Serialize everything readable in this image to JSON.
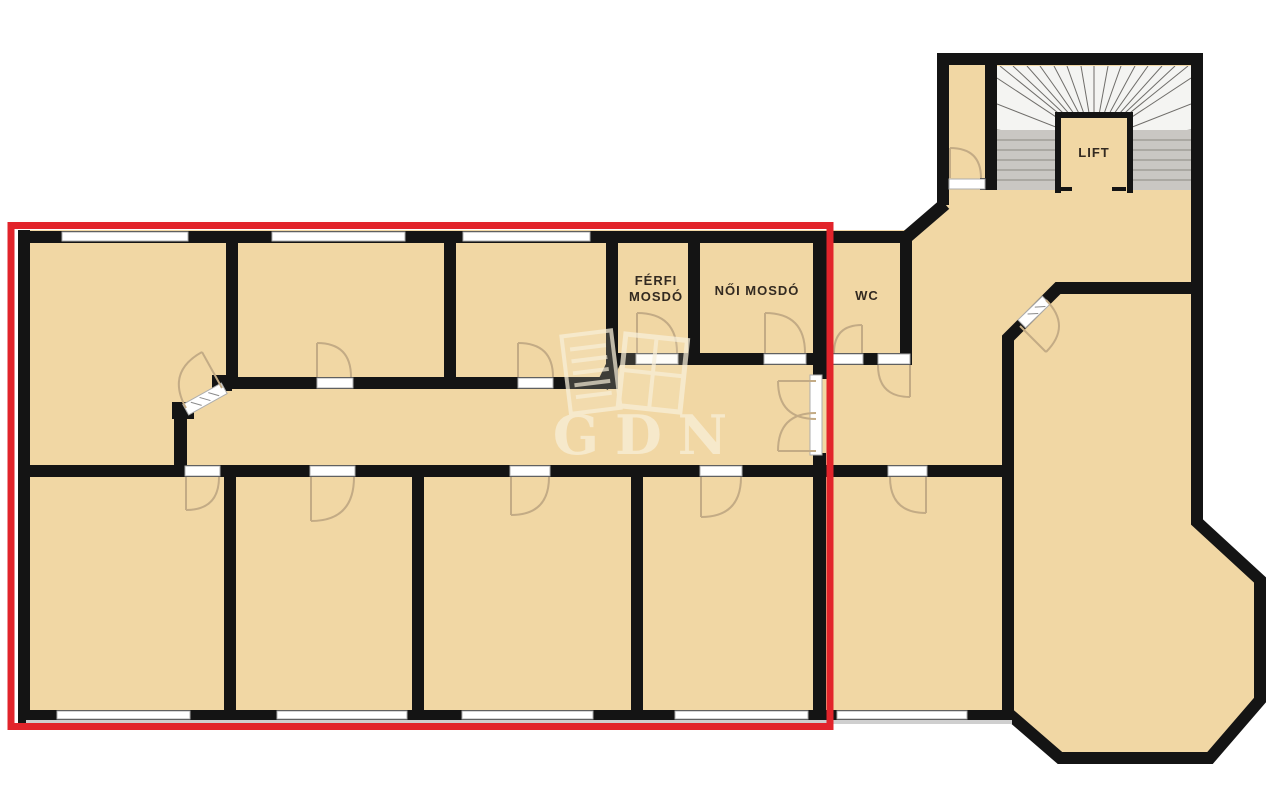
{
  "plan": {
    "type": "floor-plan",
    "labels": {
      "ferfi_room_line1": "FÉRFI",
      "ferfi_room_line2": "MOSDÓ",
      "noi_room": "NŐI MOSDÓ",
      "wc_room": "WC",
      "lift": "LIFT"
    },
    "watermark_text": "GDN",
    "colors": {
      "floor": "#f1d7a4",
      "wall": "#141414",
      "window": "#ffffff",
      "highlight_red": "#e2242b",
      "stair_tread": "#c9c7c3",
      "stair_fan": "#f4f4f2",
      "door_arc": "#c3ab85",
      "watermark": "#f8efd9",
      "label": "#332a21"
    }
  }
}
